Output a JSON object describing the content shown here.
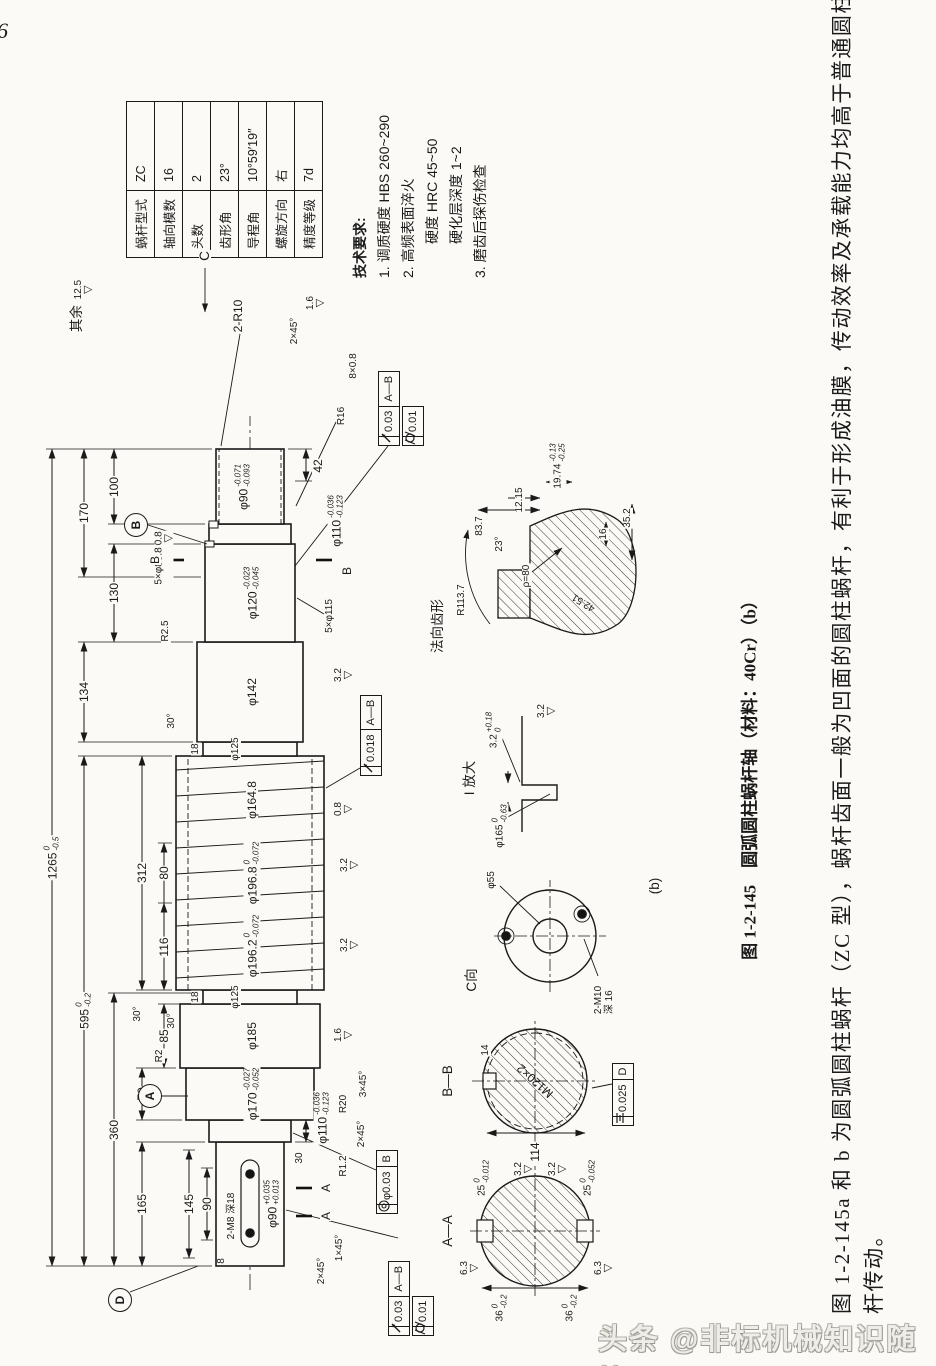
{
  "page": {
    "number": "6",
    "watermark": "头条 @非标机械知识随笔"
  },
  "worm_table": {
    "rows": [
      {
        "label": "蜗杆型式",
        "value": "ZC"
      },
      {
        "label": "轴向模数",
        "value": "16"
      },
      {
        "label": "头数",
        "value": "2"
      },
      {
        "label": "齿形角",
        "value": "23°"
      },
      {
        "label": "导程角",
        "value": "10°59′19″"
      },
      {
        "label": "螺旋方向",
        "value": "右"
      },
      {
        "label": "精度等级",
        "value": "7d"
      }
    ]
  },
  "tech_requirements": {
    "title": "技术要求:",
    "items": [
      "1. 调质硬度 HBS 260~290",
      "2. 高频表面淬火",
      "硬度 HRC 45~50",
      "硬化层深度 1~2",
      "3. 磨齿后探伤检查"
    ]
  },
  "figure_caption": "图 1-2-145　圆弧圆柱蜗杆轴（材料：40Cr）（b）",
  "body_text": {
    "line1": "图 1-2-145a 和 b 为圆弧圆柱蜗杆（ZC 型），蜗杆齿面一般为凹面的圆柱蜗杆，有利于形成油膜，传动效率及承载能力均高于普通圆柱蜗",
    "line2": "杆传动。"
  },
  "drawing": {
    "surface_note": {
      "prefix": "其余",
      "value": "12.5"
    },
    "datums": {
      "A": "A",
      "B": "B",
      "D": "D"
    },
    "views": {
      "c_arrow": "C",
      "c_view": "C向",
      "detail_i": "I 放大",
      "sub_label": "(b)",
      "section_aa": "A—A",
      "section_bb": "B—B",
      "profile_label": "法向齿形"
    },
    "frames": {
      "runout_worm": "0.018",
      "runout_jrn": "0.03",
      "cylindricity": "0.01",
      "concentricity": "φ0.03",
      "concentricity_ref": "B",
      "symmetry": "0.025",
      "symmetry_ref": "D",
      "ref_ab": "A—B"
    },
    "dims": {
      "overall": "1265",
      "overall_u": "0",
      "overall_l": "-0.5",
      "len595": "595",
      "len595_u": "0",
      "len595_l": "-0.2",
      "len360": "360",
      "len170": "170",
      "len165": "165",
      "len134": "134",
      "len130": "130",
      "len116": "116",
      "len100": "100",
      "len312": "312",
      "len80": "80",
      "len90": "90",
      "len145": "145",
      "len42": "42",
      "len30": "30",
      "len18": "18",
      "len8": "8",
      "len70": "70",
      "len85": "85",
      "ang30": "30°",
      "ang23": "23°",
      "ch1x45": "1×45°",
      "ch2x45": "2×45°",
      "ch3x45": "3×45°",
      "r2": "R2",
      "r25": "R2.5",
      "r12": "R1.2",
      "r16": "R16",
      "r20": "R20",
      "r10": "2-R10",
      "r1137": "R113.7",
      "relief": "8×0.8",
      "phi90r": "φ90",
      "phi90r_u": "-0.071",
      "phi90r_l": "-0.093",
      "phi90l": "φ90",
      "phi90l_u": "+0.035",
      "phi90l_l": "+0.013",
      "phi110": "φ110",
      "phi110_u": "-0.036",
      "phi110_l": "-0.123",
      "phi115": "5×φ115",
      "phi88": "5×φ88.8",
      "phi120": "φ120",
      "phi120_u": "-0.023",
      "phi120_l": "-0.045",
      "phi125": "φ125",
      "phi142": "φ142",
      "phi185": "φ185",
      "phi164": "φ164.8",
      "phi1962": "φ196.2",
      "phi1962_u": "0",
      "phi1962_l": "-0.072",
      "phi1968": "φ196.8",
      "phi1968_u": "0",
      "phi1968_l": "-0.072",
      "phi170": "φ170",
      "phi170_u": "-0.027",
      "phi170_l": "-0.052",
      "phi165": "φ165",
      "phi165_u": "0",
      "phi165_l": "-0.63",
      "phi55": "φ55",
      "m8": "2-M8 深18",
      "m10": "2-M10",
      "m10depth": "深 16",
      "m120": "M120×2",
      "w114": "114",
      "w14": "14",
      "k36": "36",
      "k36_u": "0",
      "k36_l": "-0.2",
      "k25a": "25",
      "k25a_u": "0",
      "k25a_l": "-0.012",
      "k25b": "25",
      "k25b_u": "0",
      "k25b_l": "-0.052",
      "g32": "3.2",
      "g32_u": "+0.18",
      "g32_l": "0",
      "p837": "83.7",
      "p1215": "12.15",
      "p4251": "42.51",
      "p16": "16",
      "p352": "35.2",
      "rho": "ρ=80",
      "p1974": "19.74",
      "p1974_u": "-0.13",
      "p1974_l": "-0.25",
      "ra08": "0.8",
      "ra16": "1.6",
      "ra32": "3.2",
      "ra63": "6.3"
    }
  }
}
